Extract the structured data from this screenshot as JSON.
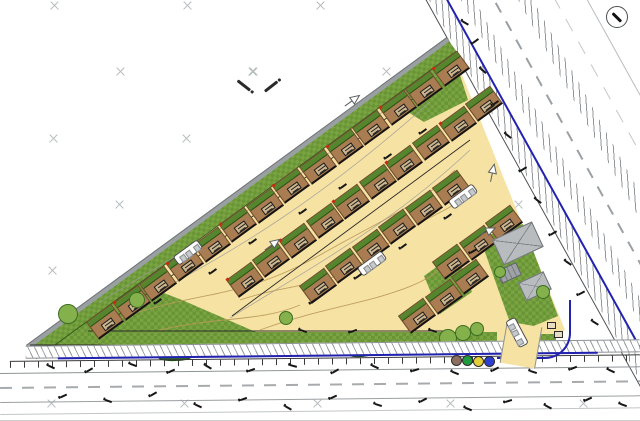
{
  "meta": {
    "kind": "architect-site-plan",
    "readable_text": "none"
  },
  "colors": {
    "road_yellow": "#f6e2a2",
    "plot_brown": "#a97c52",
    "plot_green": "#55862e",
    "grass_a": "#79a441",
    "grass_b": "#699537",
    "boundary_gray": "#9aa0a2",
    "utility_blue": "#2222b0",
    "building_gray": "#b9bcbe",
    "marker_brown": "#8a6f5f",
    "marker_green": "#1f9a3f",
    "marker_yellow": "#e3cf3a",
    "marker_blue": "#2d3fd0"
  },
  "north_arrow": {
    "x": 606,
    "y": 6,
    "size": 22,
    "needle_angle": 45
  },
  "survey_grid": {
    "rows": [
      {
        "y": 5,
        "xs": [
          54,
          187,
          320,
          453,
          586
        ]
      },
      {
        "y": 71,
        "xs": [
          120,
          253,
          386,
          519
        ]
      },
      {
        "y": 138,
        "xs": [
          53,
          186,
          319,
          452,
          585
        ]
      },
      {
        "y": 204,
        "xs": [
          119,
          252,
          385,
          518
        ]
      },
      {
        "y": 270,
        "xs": [
          52,
          185,
          318,
          451,
          584
        ]
      },
      {
        "y": 337,
        "xs": [
          118,
          251,
          384,
          517
        ]
      },
      {
        "y": 403,
        "xs": [
          51,
          184,
          317,
          450,
          583
        ]
      }
    ]
  },
  "survey_pair": {
    "cross": [
      252,
      71
    ],
    "bars": [
      [
        236,
        84,
        38
      ],
      [
        263,
        85,
        -38
      ]
    ]
  },
  "hyp": {
    "origin": [
      28,
      348
    ],
    "u": [
      0.806,
      -0.591
    ],
    "n": [
      0.591,
      0.806
    ],
    "angle": -36.2,
    "length": 521
  },
  "site_polygon": "28,346 448,40 565,330 540,346",
  "green_patches": [
    "30,346 120,276 182,300 256,332 256,346",
    "382,96 448,38 468,100 424,122",
    "480,238 523,224 558,316 514,334",
    "424,276 456,253 472,292 440,314",
    "88,332 497,332 497,346 88,346",
    "536,334 556,334 556,346 536,346"
  ],
  "plot_rows": [
    {
      "name": "row-hypotenuse",
      "t0": 95,
      "offset": 14,
      "spacing": 33,
      "count": 13,
      "flags": true
    },
    {
      "name": "row-middle",
      "t0": 200,
      "offset": 62,
      "spacing": 33,
      "count": 10,
      "flags": true
    },
    {
      "name": "row-lower",
      "t0": 255,
      "offset": 110,
      "spacing": 33,
      "count": 6,
      "flags": false
    },
    {
      "name": "cluster-tip",
      "anchors": [
        [
          86,
          322
        ]
      ],
      "flags": false
    },
    {
      "name": "cluster-se-low",
      "anchors": [
        [
          398,
          316
        ],
        [
          424.6,
          296.5
        ],
        [
          451.2,
          277
        ]
      ],
      "flags": false
    },
    {
      "name": "cluster-se-up",
      "anchors": [
        [
          432,
          262
        ],
        [
          458.6,
          242.5
        ],
        [
          485.2,
          223
        ]
      ],
      "flags": false
    }
  ],
  "caravans": [
    {
      "x": 188,
      "y": 252,
      "rot": -36
    },
    {
      "x": 372,
      "y": 263,
      "rot": -36
    },
    {
      "x": 463,
      "y": 196,
      "rot": -36
    },
    {
      "x": 517,
      "y": 332,
      "rot": 62
    }
  ],
  "arrows": [
    {
      "x": 272,
      "y": 240,
      "rot": -36
    },
    {
      "x": 487,
      "y": 227,
      "rot": -25
    },
    {
      "x": 492,
      "y": 168,
      "rot": -78
    },
    {
      "x": 352,
      "y": 96,
      "rot": -36
    }
  ],
  "trees": [
    [
      68,
      314,
      20
    ],
    [
      137,
      300,
      16
    ],
    [
      286,
      318,
      14
    ],
    [
      448,
      338,
      18
    ],
    [
      463,
      333,
      16
    ],
    [
      477,
      329,
      14
    ],
    [
      543,
      292,
      14
    ],
    [
      500,
      272,
      12
    ]
  ],
  "hedges": [
    {
      "x": 158,
      "y": 349,
      "w": 36,
      "h": 10,
      "rot": -4
    },
    {
      "x": 348,
      "y": 347,
      "w": 26,
      "h": 8,
      "rot": -6
    }
  ],
  "service_markers": {
    "radius": 11,
    "dots": [
      {
        "x": 451,
        "y": 355,
        "color": "#8a6f5f"
      },
      {
        "x": 462,
        "y": 355,
        "color": "#1f9a3f"
      },
      {
        "x": 473,
        "y": 356,
        "color": "#e3cf3a"
      },
      {
        "x": 484,
        "y": 356,
        "color": "#2d3fd0"
      }
    ]
  },
  "buildings": [
    {
      "x": 492,
      "y": 240,
      "w": 44,
      "h": 28,
      "rot": -25
    },
    {
      "x": 518,
      "y": 283,
      "w": 28,
      "h": 20,
      "rot": -25
    }
  ],
  "parking_bays": {
    "x": 498,
    "y": 266,
    "w": 20,
    "h": 12,
    "rot": -25
  },
  "bins": [
    [
      547,
      322
    ],
    [
      554,
      331
    ]
  ],
  "entrance": {
    "x": 503,
    "y": 324,
    "w": 34,
    "h": 42,
    "rot": 10
  },
  "spot_levels": [
    [
      48,
      366,
      25
    ],
    [
      86,
      369,
      -30
    ],
    [
      130,
      364,
      20
    ],
    [
      168,
      370,
      -25
    ],
    [
      205,
      366,
      30
    ],
    [
      248,
      369,
      -20
    ],
    [
      290,
      365,
      15
    ],
    [
      332,
      370,
      -30
    ],
    [
      372,
      366,
      25
    ],
    [
      412,
      369,
      -18
    ],
    [
      452,
      372,
      22
    ],
    [
      492,
      368,
      -28
    ],
    [
      530,
      371,
      18
    ],
    [
      570,
      367,
      -22
    ],
    [
      608,
      370,
      25
    ],
    [
      60,
      395,
      -25
    ],
    [
      105,
      400,
      20
    ],
    [
      150,
      393,
      -30
    ],
    [
      195,
      405,
      25
    ],
    [
      240,
      398,
      -20
    ],
    [
      285,
      407,
      30
    ],
    [
      330,
      396,
      -25
    ],
    [
      375,
      404,
      18
    ],
    [
      420,
      399,
      -28
    ],
    [
      465,
      408,
      22
    ],
    [
      505,
      400,
      -18
    ],
    [
      545,
      406,
      28
    ],
    [
      585,
      398,
      -24
    ],
    [
      620,
      404,
      20
    ],
    [
      480,
      70,
      40
    ],
    [
      492,
      102,
      -35
    ],
    [
      505,
      135,
      38
    ],
    [
      520,
      168,
      -32
    ],
    [
      535,
      200,
      36
    ],
    [
      550,
      232,
      -30
    ],
    [
      565,
      262,
      34
    ],
    [
      578,
      292,
      -28
    ],
    [
      592,
      322,
      32
    ],
    [
      472,
      40,
      -36
    ],
    [
      462,
      22,
      30
    ],
    [
      210,
      270,
      -36
    ],
    [
      250,
      240,
      -36
    ],
    [
      300,
      210,
      -36
    ],
    [
      340,
      185,
      -36
    ],
    [
      385,
      155,
      -36
    ],
    [
      420,
      130,
      -36
    ],
    [
      155,
      300,
      -36
    ],
    [
      310,
      300,
      -36
    ],
    [
      355,
      275,
      -36
    ],
    [
      400,
      245,
      -36
    ],
    [
      445,
      215,
      -36
    ],
    [
      470,
      250,
      -30
    ],
    [
      430,
      330,
      15
    ],
    [
      350,
      330,
      -20
    ],
    [
      300,
      330,
      18
    ]
  ],
  "contours_tan": [
    "M120,318 C200,290 240,300 320,255 S420,205 455,170",
    "M240,300 C300,280 330,290 380,250 S450,215 470,190",
    "M260,330 C340,300 420,300 455,255",
    "M160,330 C220,316 260,322 300,305"
  ],
  "contours_gray": [
    "M100,302 C180,252 260,212 420,82",
    "M140,302 C220,257 300,217 430,102",
    "M230,318 C310,268 390,225 470,150"
  ],
  "road_edge_lines": [
    [
      95,
      332,
      433,
      84
    ],
    [
      232,
      316,
      470,
      140
    ],
    [
      30,
      345,
      560,
      345
    ],
    [
      88,
      331,
      448,
      331
    ]
  ]
}
